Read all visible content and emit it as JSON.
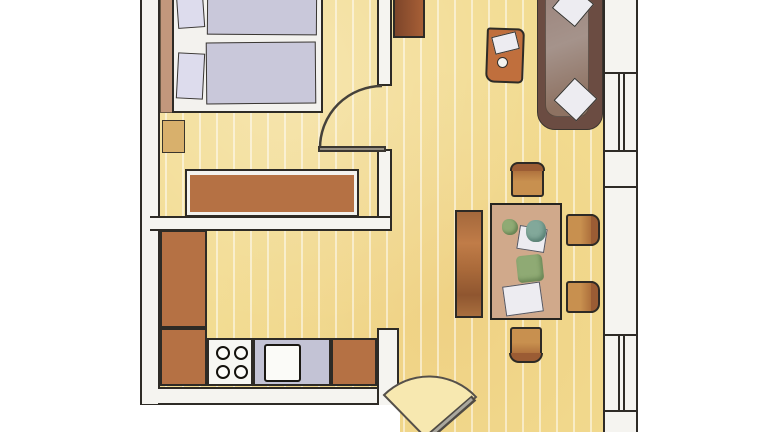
{
  "title": "apartment-floor-plan",
  "colors": {
    "line": "#2e2b26",
    "wall-fill": "#f5f4f0",
    "floor": "#f2db90",
    "floor-stripe": "rgba(255,255,255,0.5)",
    "floor-light": "#f7e8b0",
    "bed-white": "#f3f2ee",
    "mattress": "#c9c8da",
    "pillow": "#dddced",
    "headboard": "#c2977c",
    "nightstand": "#d8b06c",
    "wood": "#b57144",
    "wood-dark": "#9b5c34",
    "wood-light": "#c8904f",
    "wood-bright": "#c06f3d",
    "counter-blue": "#c3c3d5",
    "sofa-frame": "#6b4c42",
    "sofa-seat-light": "#a5938b",
    "sofa-seat-dark": "#8e7262",
    "table-top": "#d0a98b",
    "plant-green": "#8faa74",
    "teal": "#82a89a",
    "white-item": "#edecf1",
    "cabinet-dark": "#7d452a",
    "cabinet-light": "#a75f36"
  },
  "plan": {
    "style": "hand-drawn-watercolor",
    "rooms": [
      "bedroom",
      "kitchen",
      "living-dining-room"
    ],
    "doors": [
      "bedroom-swing-door",
      "entrance-swing-door"
    ],
    "windows_on_right_wall": 2,
    "furniture": [
      "double-bed",
      "pillows",
      "nightstand",
      "dresser",
      "kitchen-counter",
      "stove",
      "sink",
      "wall-cabinet",
      "sofa",
      "sofa-cushions",
      "coffee-table",
      "magazine",
      "bowl",
      "dining-table",
      "bench",
      "dining-chairs",
      "plants",
      "plates"
    ],
    "counts": {
      "stove_burners": 4,
      "dining_chairs": 4,
      "sofa_cushions": 2,
      "bed_mattresses": 2
    }
  }
}
